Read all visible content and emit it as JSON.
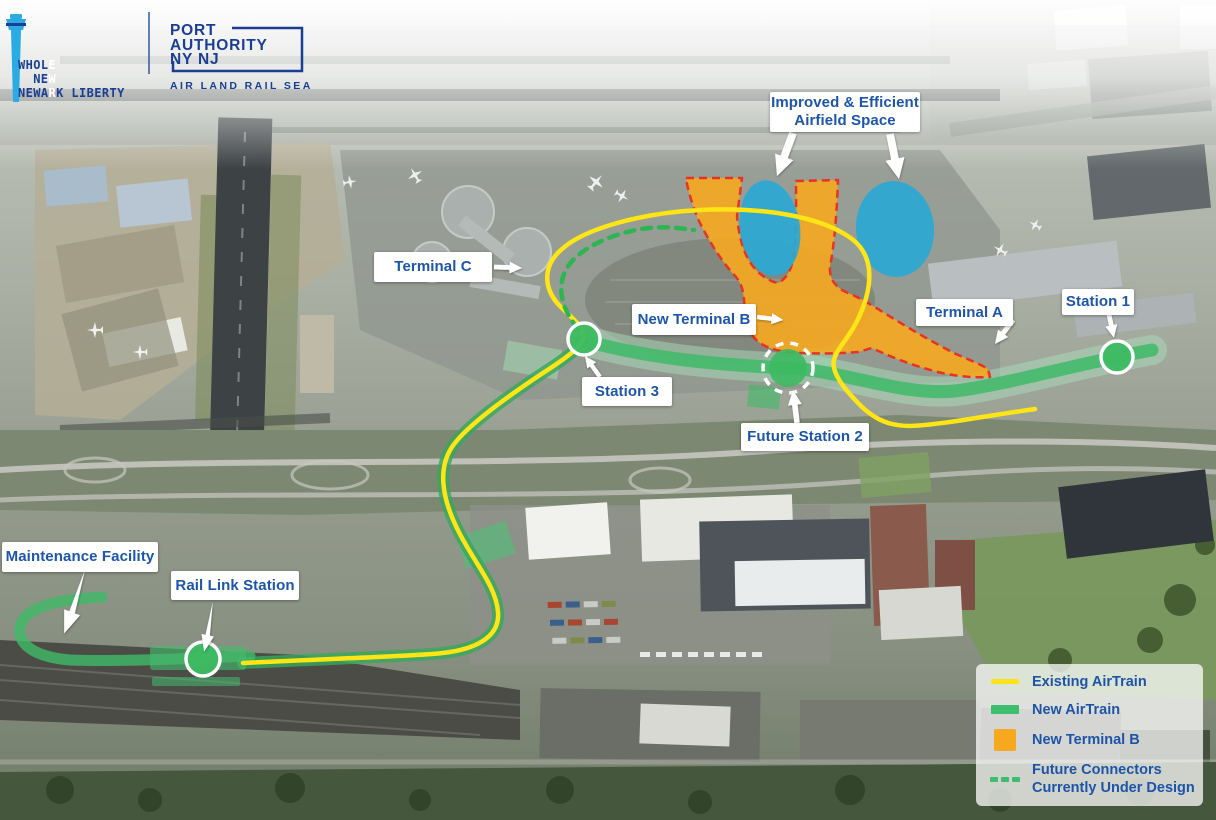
{
  "branding": {
    "ewr_logo": {
      "alt": "Whole New Newark Liberty (EWR)",
      "lines": [
        {
          "pre": "WHOL",
          "tower": "E",
          "post": ""
        },
        {
          "pre": "NE",
          "tower": "W",
          "post": ""
        },
        {
          "pre": "NEWA",
          "tower": "R",
          "post": "K LIBERTY"
        }
      ],
      "tower_color": "#2aabe3",
      "text_color": "#1b3e94"
    },
    "port_authority_logo": {
      "line1": "PORT",
      "line2": "AUTHORITY",
      "line3": "NY NJ",
      "tagline": "AIR LAND RAIL SEA",
      "color": "#1b3e94"
    }
  },
  "map_labels": {
    "improved_airfield": {
      "line1": "Improved & Efficient",
      "line2": "Airfield Space"
    },
    "terminal_c": "Terminal C",
    "new_terminal_b": "New Terminal B",
    "terminal_a": "Terminal A",
    "station_1": "Station 1",
    "station_3": "Station 3",
    "future_station_2": "Future Station 2",
    "maintenance_facility": "Maintenance Facility",
    "rail_link_station": "Rail Link Station"
  },
  "legend": {
    "text_color": "#1d54a8",
    "items": [
      {
        "label": "Existing AirTrain",
        "swatch": "line",
        "color": "#ffe11a"
      },
      {
        "label": "New AirTrain",
        "swatch": "bar",
        "color": "#3dbe6e"
      },
      {
        "label": "New Terminal B",
        "swatch": "square",
        "color": "#f6a81f"
      },
      {
        "label_line1": "Future Connectors",
        "label_line2": "Currently Under Design",
        "swatch": "dashes",
        "color": "#3dbe6e"
      }
    ]
  },
  "map_features": {
    "existing_airtrain_color": "#ffe516",
    "new_airtrain_color": "#3fba68",
    "new_terminal_b_fill": "#f6a81f",
    "new_terminal_b_border": "#e63323",
    "future_connector_color": "#2db553",
    "airfield_space_color": "#2ba8d3",
    "station_marker_fill": "#3dba62"
  }
}
